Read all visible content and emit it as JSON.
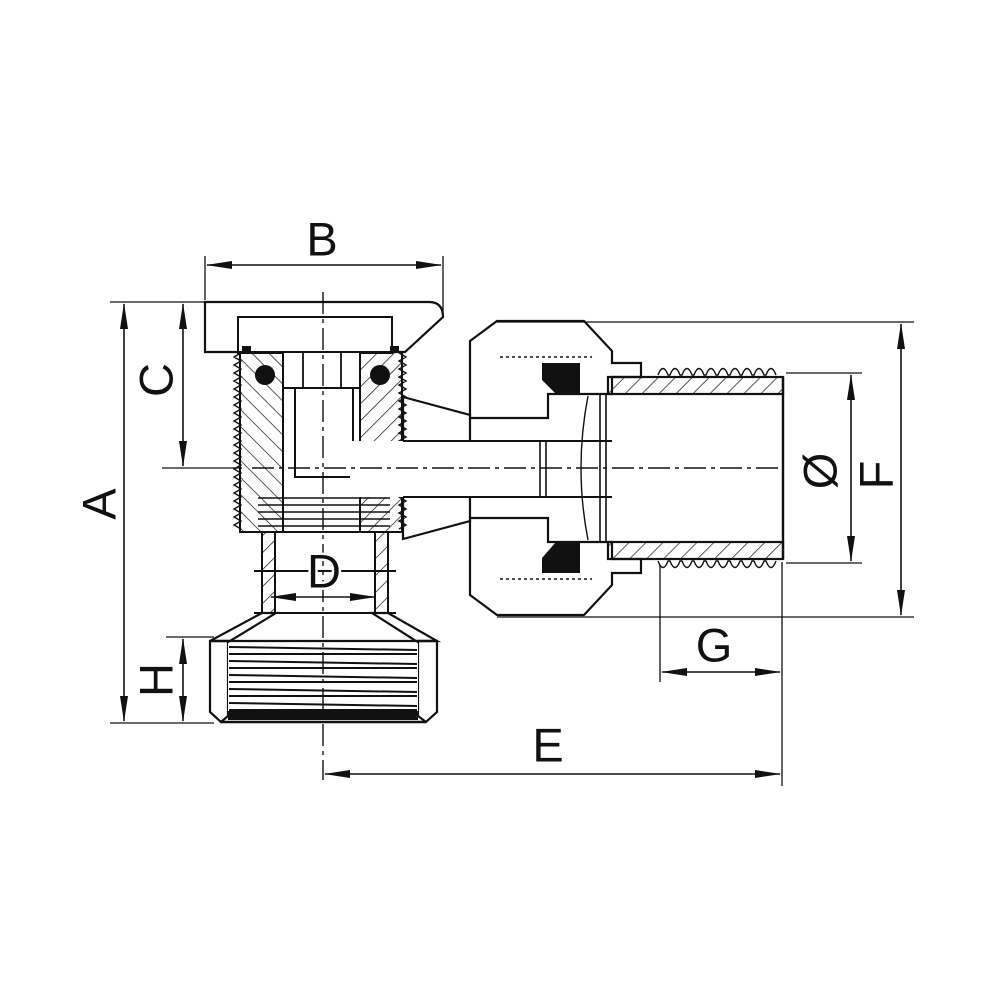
{
  "drawing": {
    "type": "technical cross-section diagram",
    "subject": "angle valve sectional drawing with dimension callouts",
    "colors": {
      "background": "#ffffff",
      "line": "#111111"
    },
    "dimensions": [
      {
        "label": "A",
        "axis": "vertical",
        "position": "left outer, overall height"
      },
      {
        "label": "B",
        "axis": "horizontal",
        "position": "top, flange width"
      },
      {
        "label": "C",
        "axis": "vertical",
        "position": "left inner, top to center axis"
      },
      {
        "label": "D",
        "axis": "horizontal",
        "position": "middle, neck diameter"
      },
      {
        "label": "E",
        "axis": "horizontal",
        "position": "bottom, center axis to pipe end"
      },
      {
        "label": "F",
        "axis": "vertical",
        "position": "right outer, union nut height"
      },
      {
        "label": "G",
        "axis": "horizontal",
        "position": "right lower, thread length"
      },
      {
        "label": "H",
        "axis": "vertical",
        "position": "left lower, nut height"
      },
      {
        "label": "Ø",
        "axis": "vertical",
        "position": "right, pipe thread outer diameter"
      }
    ]
  }
}
